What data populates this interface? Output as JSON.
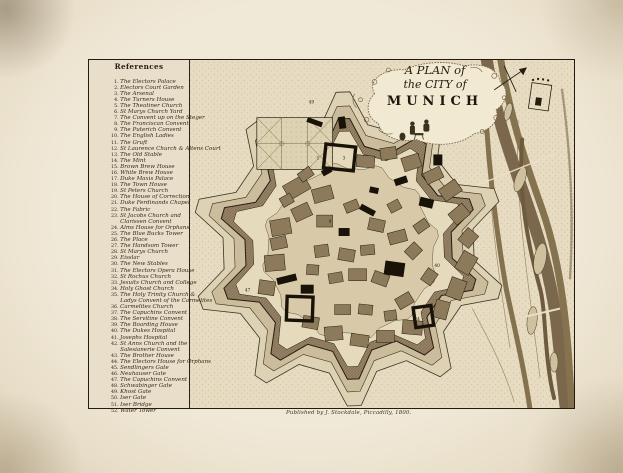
{
  "page": {
    "title_lines": [
      "A PLAN of",
      "the CITY of",
      "MUNICH"
    ],
    "publisher": "Published by J. Stockdale, Piccadilly, 1800."
  },
  "colors": {
    "paper_mat": "#f1e9d8",
    "plate_paper": "#e9decb",
    "ink": "#241d11",
    "rampart": "#9a8568",
    "river": "#7b684c"
  },
  "references": {
    "header": "References",
    "items": [
      {
        "n": "1.",
        "t": "The Electors Palace"
      },
      {
        "n": "2.",
        "t": "Electors Court Garden"
      },
      {
        "n": "3.",
        "t": "The Arsenal"
      },
      {
        "n": "4.",
        "t": "The Turners House"
      },
      {
        "n": "5.",
        "t": "The Theatiner Church"
      },
      {
        "n": "6.",
        "t": "St Marys Church Yard"
      },
      {
        "n": "7.",
        "t": "The Convent up on the Steger"
      },
      {
        "n": "8.",
        "t": "The Franciscan Convent"
      },
      {
        "n": "9.",
        "t": "The Puterich Convent"
      },
      {
        "n": "10.",
        "t": "The English Ladies"
      },
      {
        "n": "11.",
        "t": "The Gruft"
      },
      {
        "n": "12.",
        "t": "St Laurence Church & Altens Court"
      },
      {
        "n": "13.",
        "t": "The Old Stable"
      },
      {
        "n": "14.",
        "t": "The Mint"
      },
      {
        "n": "15.",
        "t": "Brown Brew House"
      },
      {
        "n": "16.",
        "t": "White Brew House"
      },
      {
        "n": "17.",
        "t": "Duke Maxis Palace"
      },
      {
        "n": "18.",
        "t": "The Town House"
      },
      {
        "n": "19.",
        "t": "St Peters Church"
      },
      {
        "n": "20.",
        "t": "The House of Correction"
      },
      {
        "n": "21.",
        "t": "Duke Ferdinands Chapel"
      },
      {
        "n": "22.",
        "t": "The Fabric"
      },
      {
        "n": "23.",
        "t": "St Jacobs Church and"
      },
      {
        "n": "",
        "t": "Clarissen Convent"
      },
      {
        "n": "24.",
        "t": "Alms House for Orphans"
      },
      {
        "n": "25.",
        "t": "The Blue Bucks Tower"
      },
      {
        "n": "26.",
        "t": "The Place"
      },
      {
        "n": "27.",
        "t": "The Handsom Tower"
      },
      {
        "n": "28.",
        "t": "St Marys Church"
      },
      {
        "n": "29.",
        "t": "Eisslar"
      },
      {
        "n": "30.",
        "t": "The New Stables"
      },
      {
        "n": "31.",
        "t": "The Electors Opera House"
      },
      {
        "n": "32.",
        "t": "St Rochus Church"
      },
      {
        "n": "33.",
        "t": "Jesuits Church and College"
      },
      {
        "n": "34.",
        "t": "Holy Ghost Church"
      },
      {
        "n": "35.",
        "t": "The Holy Trinity Church &"
      },
      {
        "n": "",
        "t": "Ladys Convent of the Carmelites"
      },
      {
        "n": "36.",
        "t": "Carmelites Church"
      },
      {
        "n": "37.",
        "t": "The Capuchins Convent"
      },
      {
        "n": "38.",
        "t": "The Servitine Convent"
      },
      {
        "n": "39.",
        "t": "The Boarding House"
      },
      {
        "n": "40.",
        "t": "The Dukes Hospital"
      },
      {
        "n": "41.",
        "t": "Josephs Hospital"
      },
      {
        "n": "42.",
        "t": "St Anns Church and the"
      },
      {
        "n": "",
        "t": "Salesianerie Convent"
      },
      {
        "n": "43.",
        "t": "The Brother House"
      },
      {
        "n": "44.",
        "t": "The Electors House for Orphans"
      },
      {
        "n": "45.",
        "t": "Sendlingers Gate"
      },
      {
        "n": "46.",
        "t": "Neuhauser Gate"
      },
      {
        "n": "47.",
        "t": "The Capuchins Convent"
      },
      {
        "n": "48.",
        "t": "Schwabinger Gate"
      },
      {
        "n": "49.",
        "t": "Khost Gate"
      },
      {
        "n": "50.",
        "t": "Iser Gate"
      },
      {
        "n": "51.",
        "t": "Iser Bridge"
      },
      {
        "n": "52.",
        "t": "Water Tower"
      }
    ]
  },
  "map_labels": [
    {
      "t": "1",
      "x": 128,
      "y": 100
    },
    {
      "t": "3",
      "x": 154,
      "y": 100
    },
    {
      "t": "9",
      "x": 140,
      "y": 164
    },
    {
      "t": "40",
      "x": 246,
      "y": 208
    },
    {
      "t": "24",
      "x": 226,
      "y": 262
    },
    {
      "t": "47",
      "x": 56,
      "y": 233
    },
    {
      "t": "49",
      "x": 120,
      "y": 44
    }
  ]
}
